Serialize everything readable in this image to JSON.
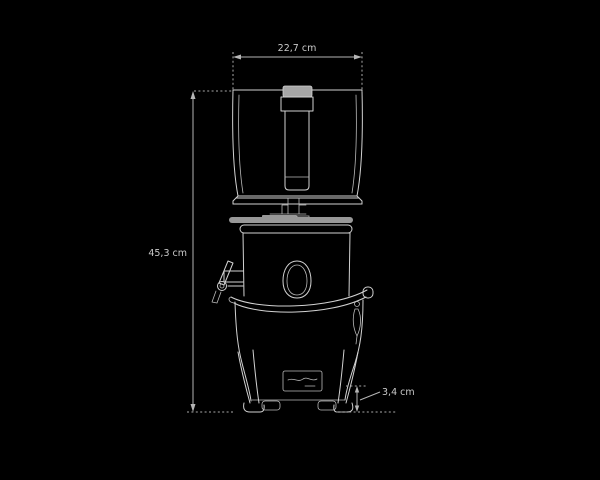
{
  "figure": {
    "type": "technical-dimension-diagram",
    "subject": "juicer front elevation line drawing",
    "background": "#000000"
  },
  "colors": {
    "background": "#000000",
    "outline": "#d2d2d2",
    "dimension_lines": "#b5b5b5",
    "label_text": "#c9c9c9",
    "cap_fill": "#a6a6a6",
    "collar_fill": "#989898"
  },
  "dimensions": {
    "width": {
      "label": "22,7 cm",
      "position": "top"
    },
    "height": {
      "label": "45,3 cm",
      "position": "left"
    },
    "clearance": {
      "label": "3,4 cm",
      "position": "bottom-right"
    }
  }
}
